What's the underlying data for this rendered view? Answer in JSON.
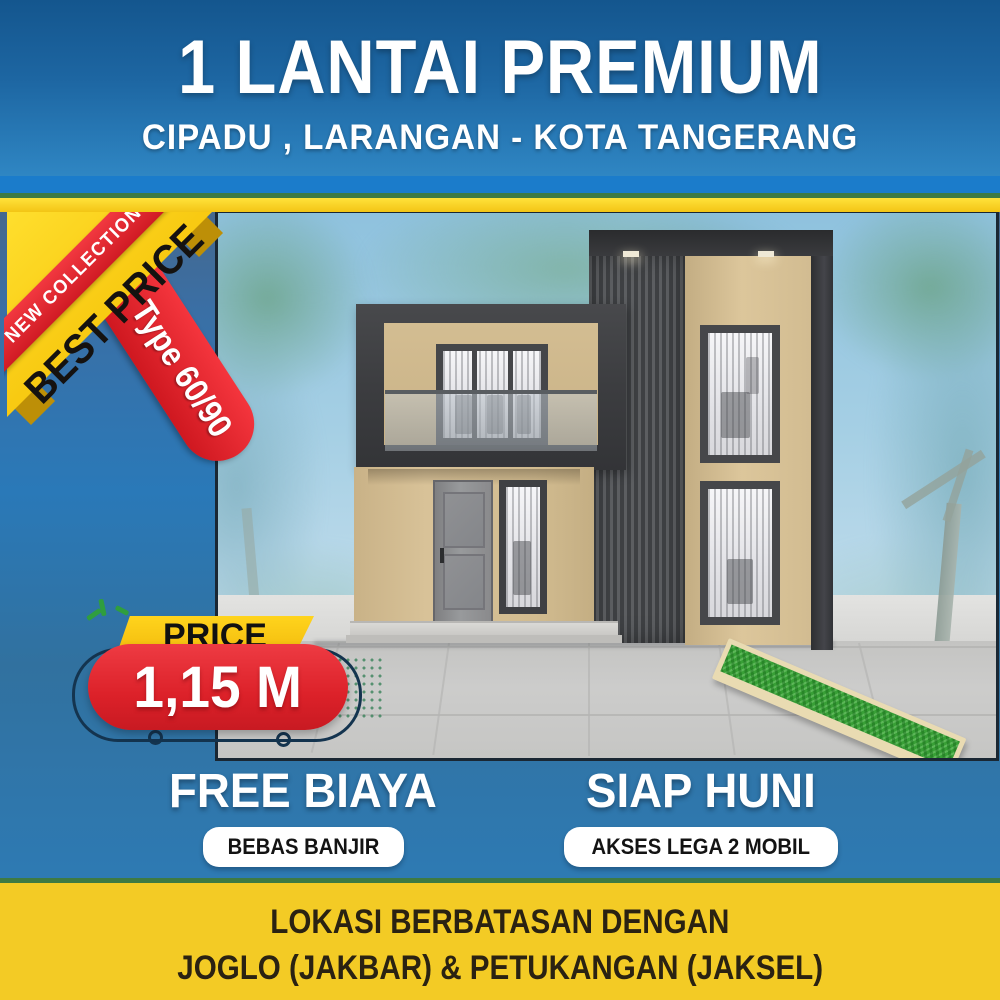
{
  "header": {
    "title": "1 LANTAI PREMIUM",
    "subtitle": "CIPADU , LARANGAN - KOTA TANGERANG"
  },
  "corner_badge": {
    "new_collection": "NEW COLLECTION",
    "best_price": "BEST PRICE",
    "type": "Type 60/90"
  },
  "price_badge": {
    "label": "PRICE",
    "value": "1,15 M"
  },
  "features": [
    {
      "title": "FREE BIAYA",
      "badge": "BEBAS BANJIR"
    },
    {
      "title": "SIAP HUNI",
      "badge": "AKSES LEGA 2 MOBIL"
    }
  ],
  "footer": {
    "line1": "LOKASI BERBATASAN DENGAN",
    "line2": "JOGLO (JAKBAR) & PETUKANGAN (JAKSEL)"
  },
  "colors": {
    "header_blue": "#2f86c3",
    "accent_yellow": "#f3c515",
    "ribbon_red": "#dc2129",
    "footer_yellow": "#f3cb25",
    "sky_blue": "#8fc2de",
    "grass_green": "#389f36"
  }
}
